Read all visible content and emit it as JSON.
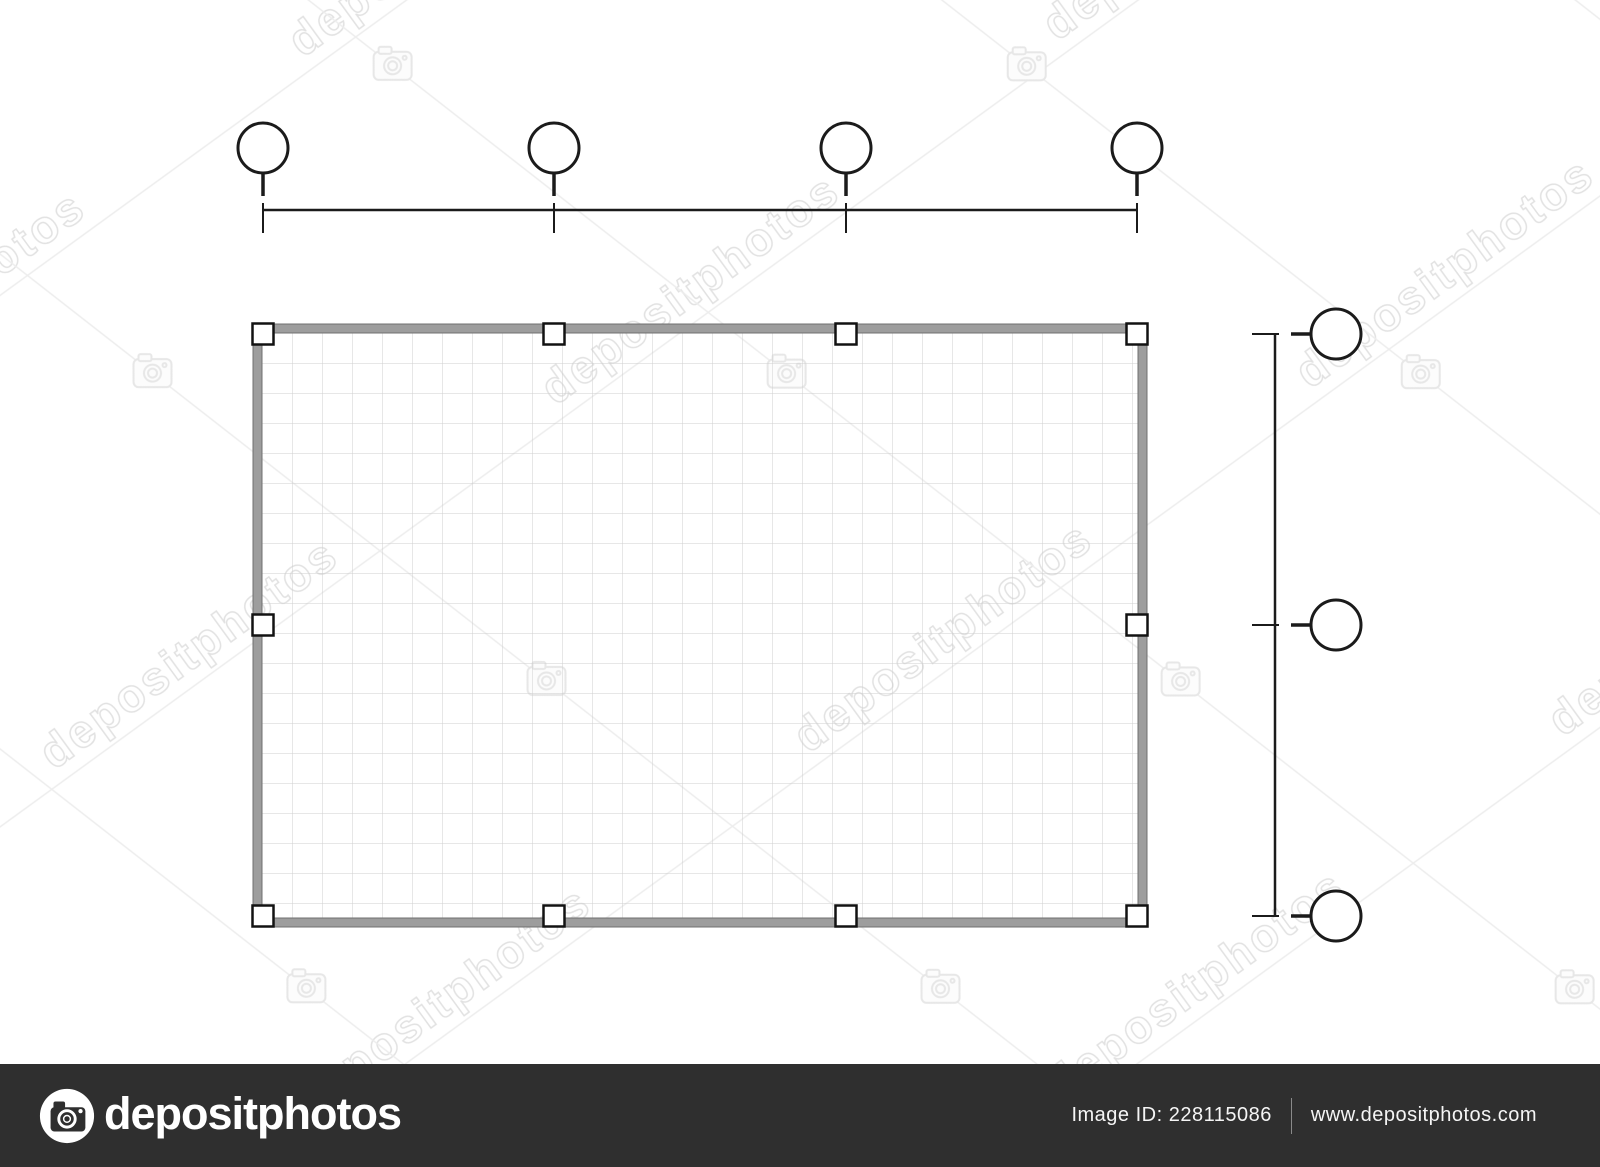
{
  "meta": {
    "canvas_width": 1600,
    "canvas_height": 1167,
    "background": "#ffffff",
    "description": "Stock image of an architectural floor-plan grid drawing with empty column axis bubbles"
  },
  "drawing": {
    "type": "floor-plan-grid",
    "column_axes_x": [
      263,
      554,
      846,
      1137
    ],
    "row_axes_y": [
      334,
      625,
      916
    ],
    "top_dimension": {
      "line_y": 210,
      "x_start": 263,
      "x_end": 1137,
      "circle_cy": 148,
      "circle_r": 25,
      "stem_y1": 173,
      "stem_y2": 196,
      "tick_y1": 203,
      "tick_y2": 233
    },
    "right_dimension": {
      "line_x": 1275,
      "y_start": 334,
      "y_end": 916,
      "circle_cx": 1336,
      "circle_r": 25,
      "stem_x1": 1291,
      "stem_x2": 1311,
      "tick_x1": 1252,
      "tick_x2": 1279
    },
    "plan_rect": {
      "left": 253,
      "top": 324,
      "right": 1147,
      "bottom": 927,
      "wall_thickness": 9
    },
    "column_marker_size": 21,
    "grid_cell": 30,
    "colors": {
      "wall_fill": "#9d9d9d",
      "wall_edge": "#707070",
      "grid_line": "#cfcfcf",
      "ink": "#1b1b1b",
      "marker_fill": "#ffffff",
      "marker_border": "#121212"
    }
  },
  "watermark": {
    "text": "depositphotos",
    "tint": "#e7e7e7",
    "icon": "camera-icon"
  },
  "footer": {
    "bar_color": "#2f2f2f",
    "logo_icon": "camera-logo-icon",
    "logo_text": "depositphotos",
    "image_id": "Image ID: 228115086",
    "website": "www.depositphotos.com",
    "text_color": "#ffffff"
  }
}
